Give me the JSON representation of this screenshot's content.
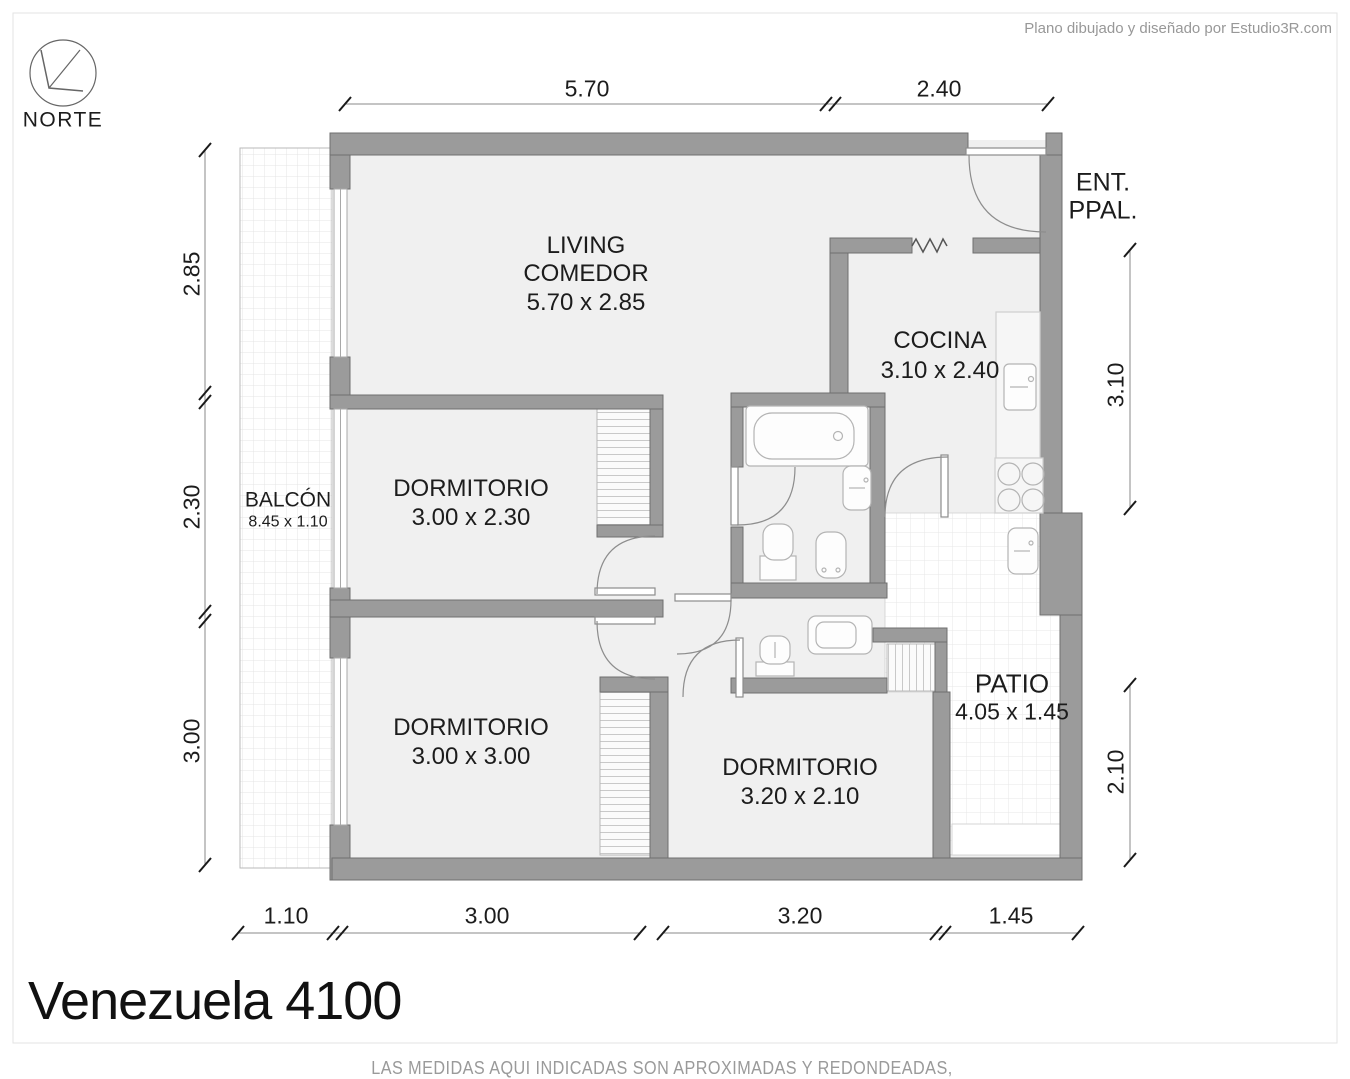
{
  "header": {
    "credit": "Plano dibujado y diseñado por Estudio3R.com"
  },
  "compass": {
    "label": "NORTE"
  },
  "entry": {
    "line1": "ENT.",
    "line2": "PPAL."
  },
  "rooms": {
    "living": {
      "name_line1": "LIVING",
      "name_line2": "COMEDOR",
      "size": "5.70 x 2.85"
    },
    "cocina": {
      "name": "COCINA",
      "size": "3.10 x 2.40"
    },
    "balcon": {
      "name": "BALCÓN",
      "size": "8.45 x 1.10"
    },
    "dormitorio_1": {
      "name": "DORMITORIO",
      "size": "3.00 x 2.30"
    },
    "dormitorio_2": {
      "name": "DORMITORIO",
      "size": "3.00 x 3.00"
    },
    "dormitorio_3": {
      "name": "DORMITORIO",
      "size": "3.20 x 2.10"
    },
    "patio": {
      "name": "PATIO",
      "size": "4.05 x 1.45"
    }
  },
  "dimensions": {
    "top": [
      "5.70",
      "2.40"
    ],
    "left": [
      "2.85",
      "2.30",
      "3.00"
    ],
    "right": [
      "3.10",
      "2.10"
    ],
    "bottom": [
      "1.10",
      "3.00",
      "3.20",
      "1.45"
    ]
  },
  "footer": {
    "title": "Venezuela 4100",
    "disclaimer": "LAS MEDIDAS AQUI INDICADAS SON APROXIMADAS Y REDONDEADAS, LAS ORIGINALES SON LAS EXPRESADAS EN EL TITULO DE PROPIEDAD"
  },
  "colors": {
    "wall": "#9b9b9b",
    "room_fill": "#f0f0f0",
    "tile_line": "#e4e4e4",
    "muted_text": "#9a9a9a"
  }
}
